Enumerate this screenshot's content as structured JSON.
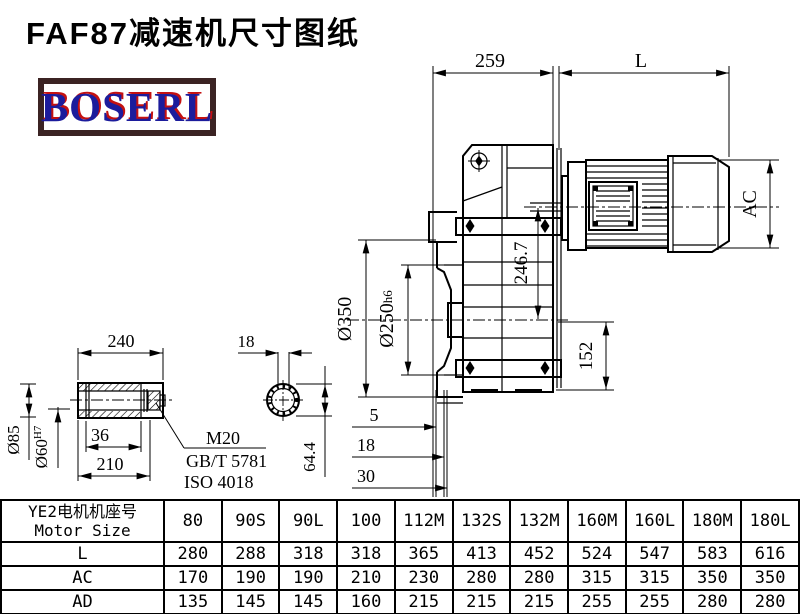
{
  "title": "FAF87减速机尺寸图纸",
  "logo": {
    "text": "BOSERL"
  },
  "dims": {
    "d259": "259",
    "dL": "L",
    "dAC": "AC",
    "d2467": "246.7",
    "d152": "152",
    "d350": "Ø350",
    "d250": "Ø250",
    "d250tol": "h6",
    "s5": "5",
    "s18": "18",
    "s30": "30",
    "d240": "240",
    "d85": "Ø85",
    "d60": "Ø60",
    "d60tol": "H7",
    "d36": "36",
    "d210": "210",
    "m20": "M20",
    "std1": "GB/T 5781",
    "std2": "ISO 4018",
    "key18": "18",
    "d644": "64.4"
  },
  "table": {
    "header_cn": "YE2电机机座号",
    "header_en": "Motor Size",
    "columns": [
      "80",
      "90S",
      "90L",
      "100",
      "112M",
      "132S",
      "132M",
      "160M",
      "160L",
      "180M",
      "180L"
    ],
    "rows": [
      {
        "label": "L",
        "values": [
          "280",
          "288",
          "318",
          "318",
          "365",
          "413",
          "452",
          "524",
          "547",
          "583",
          "616"
        ]
      },
      {
        "label": "AC",
        "values": [
          "170",
          "190",
          "190",
          "210",
          "230",
          "280",
          "280",
          "315",
          "315",
          "350",
          "350"
        ]
      },
      {
        "label": "AD",
        "values": [
          "135",
          "145",
          "145",
          "160",
          "215",
          "215",
          "215",
          "255",
          "255",
          "280",
          "280"
        ]
      }
    ]
  }
}
